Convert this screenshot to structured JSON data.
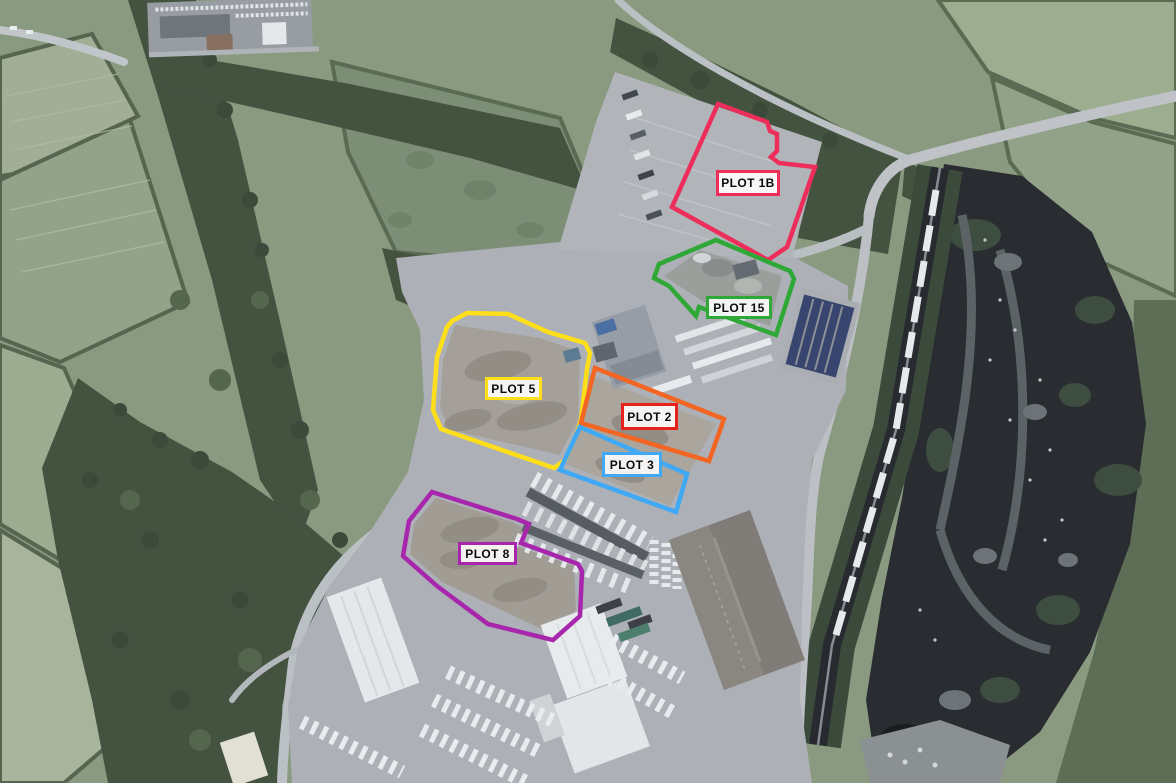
{
  "map": {
    "type": "aerial-site-plan",
    "outline_width": 4.5,
    "plots": [
      {
        "id": "plot-1b",
        "label": "PLOT 1B",
        "color": "#ED2E5B",
        "points": "718,104 767,122 770,131 777,134 777,151 771,157 779,163 815,167 787,247 768,260 672,207",
        "label_box": {
          "x": 716,
          "y": 170,
          "w": 64,
          "h": 26
        }
      },
      {
        "id": "plot-15",
        "label": "PLOT 15",
        "color": "#2FA838",
        "points": "716,240 790,271 794,279 776,335 699,307 696,316 669,286 654,278 659,264",
        "label_box": {
          "x": 706,
          "y": 296,
          "w": 66,
          "h": 23
        }
      },
      {
        "id": "plot-5",
        "label": "PLOT 5",
        "color": "#FFDE1A",
        "points": "452,321 467,313 508,314 548,332 585,343 590,353 587,369 581,420 577,433 565,460 554,468 441,429 433,410 437,357 447,327",
        "label_box": {
          "x": 485,
          "y": 377,
          "w": 57,
          "h": 23
        }
      },
      {
        "id": "plot-2",
        "label": "PLOT 2",
        "color": "#F26522",
        "label_border": "#E8211D",
        "points": "595,368 724,419 709,461 581,423",
        "label_box": {
          "x": 621,
          "y": 403,
          "w": 57,
          "h": 27
        }
      },
      {
        "id": "plot-3",
        "label": "PLOT 3",
        "color": "#3FA9F5",
        "points": "580,427 687,474 676,512 560,470",
        "label_box": {
          "x": 602,
          "y": 452,
          "w": 60,
          "h": 25
        }
      },
      {
        "id": "plot-8",
        "label": "PLOT 8",
        "color": "#A826AC",
        "points": "432,492 517,519 529,524 521,543 578,564 582,571 580,616 553,640 488,624 437,586 403,556 409,521",
        "label_box": {
          "x": 458,
          "y": 542,
          "w": 59,
          "h": 23
        }
      }
    ]
  }
}
